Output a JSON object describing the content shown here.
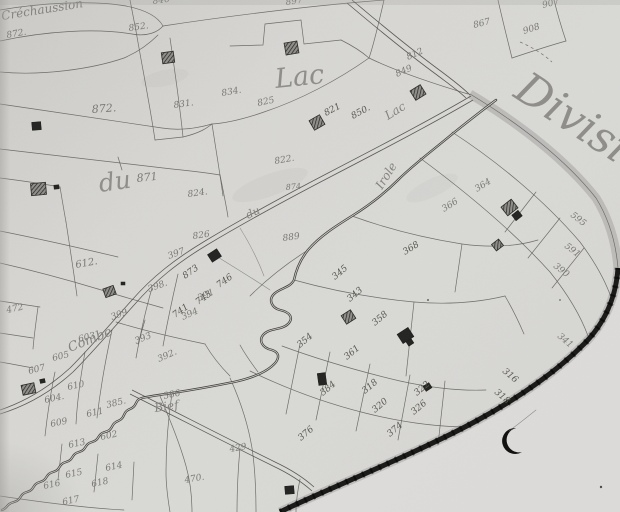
{
  "colors": {
    "paper": "#d7d6d3",
    "paper-light": "#dedddb",
    "paper-dark": "#b9b8b5",
    "ink-line": "#63625e",
    "ink-road": "#55544f",
    "ink-stream": "#45443f",
    "ink-band": "#1b1b19",
    "ink-number": "#7b7a75",
    "ink-number-dark": "#59584f",
    "ink-label": "#84837e",
    "ink-building": "#2b2b28",
    "strip": "#b3b2af"
  },
  "map": {
    "large_labels": [
      {
        "text": "Division",
        "name": "division-label",
        "x": 512,
        "y": 96,
        "r": 33,
        "s": 44
      },
      {
        "text": "Lac",
        "name": "lac-large-label",
        "x": 276,
        "y": 88,
        "r": -6,
        "s": 27
      },
      {
        "text": "du",
        "name": "du-large-label",
        "x": 100,
        "y": 192,
        "r": -8,
        "s": 25
      }
    ],
    "small_labels": [
      {
        "text": "Créchaussion",
        "name": "crechaussion-label",
        "x": 2,
        "y": 20,
        "r": -9,
        "s": 12
      },
      {
        "text": "Combe",
        "name": "combe-label",
        "x": 70,
        "y": 352,
        "r": -22,
        "s": 13
      },
      {
        "text": "Bief",
        "name": "bief-label",
        "x": 155,
        "y": 412,
        "r": -8,
        "s": 12
      },
      {
        "text": "Lac",
        "name": "lac-small-label",
        "x": 388,
        "y": 120,
        "r": -32,
        "s": 12
      },
      {
        "text": "du",
        "name": "du-small-label",
        "x": 248,
        "y": 219,
        "r": -26,
        "s": 11
      },
      {
        "text": "Irole",
        "name": "irole-stream-label",
        "x": 382,
        "y": 190,
        "r": -58,
        "s": 12
      }
    ],
    "parcel_numbers": [
      {
        "t": "852.",
        "x": 129,
        "y": 31,
        "r": -8
      },
      {
        "t": "846",
        "x": 153,
        "y": 4,
        "r": -8
      },
      {
        "t": "897",
        "x": 286,
        "y": 5,
        "r": -8
      },
      {
        "t": "872.",
        "x": 7,
        "y": 38,
        "r": -10
      },
      {
        "t": "907",
        "x": 543,
        "y": 8,
        "r": -14
      },
      {
        "t": "908",
        "x": 524,
        "y": 34,
        "r": -18
      },
      {
        "t": "867",
        "x": 474,
        "y": 28,
        "r": -14
      },
      {
        "t": "812",
        "x": 408,
        "y": 60,
        "r": -24
      },
      {
        "t": "849",
        "x": 397,
        "y": 77,
        "r": -24
      },
      {
        "t": "872.",
        "x": 92,
        "y": 113,
        "r": -4,
        "s": 11
      },
      {
        "t": "834.",
        "x": 222,
        "y": 96,
        "r": -10
      },
      {
        "t": "825",
        "x": 258,
        "y": 106,
        "r": -12
      },
      {
        "t": "831.",
        "x": 174,
        "y": 108,
        "r": -8
      },
      {
        "t": "850.",
        "x": 353,
        "y": 119,
        "r": -28,
        "dk": 1
      },
      {
        "t": "821",
        "x": 326,
        "y": 116,
        "r": -28,
        "dk": 1
      },
      {
        "t": "822.",
        "x": 275,
        "y": 164,
        "r": -10
      },
      {
        "t": "824.",
        "x": 188,
        "y": 197,
        "r": -8
      },
      {
        "t": "874",
        "x": 286,
        "y": 190,
        "r": -5,
        "s": 8
      },
      {
        "t": "871",
        "x": 137,
        "y": 182,
        "r": -6,
        "s": 11
      },
      {
        "t": "826",
        "x": 193,
        "y": 239,
        "r": -8
      },
      {
        "t": "889",
        "x": 283,
        "y": 241,
        "r": -8
      },
      {
        "t": "612.",
        "x": 76,
        "y": 268,
        "r": -10,
        "s": 10
      },
      {
        "t": "472",
        "x": 7,
        "y": 313,
        "r": -12
      },
      {
        "t": "397",
        "x": 169,
        "y": 259,
        "r": -20
      },
      {
        "t": "398.",
        "x": 149,
        "y": 292,
        "r": -20
      },
      {
        "t": "399",
        "x": 112,
        "y": 320,
        "r": -20
      },
      {
        "t": "391",
        "x": 199,
        "y": 301,
        "r": -24
      },
      {
        "t": "394",
        "x": 183,
        "y": 320,
        "r": -24
      },
      {
        "t": "393",
        "x": 136,
        "y": 344,
        "r": -22
      },
      {
        "t": "392.",
        "x": 159,
        "y": 362,
        "r": -24
      },
      {
        "t": "385.",
        "x": 107,
        "y": 408,
        "r": -14
      },
      {
        "t": "386",
        "x": 164,
        "y": 399,
        "r": -12
      },
      {
        "t": "605",
        "x": 53,
        "y": 361,
        "r": -14
      },
      {
        "t": "603",
        "x": 79,
        "y": 342,
        "r": -14
      },
      {
        "t": "607",
        "x": 29,
        "y": 374,
        "r": -14
      },
      {
        "t": "610",
        "x": 68,
        "y": 390,
        "r": -12
      },
      {
        "t": "604.",
        "x": 45,
        "y": 403,
        "r": -12
      },
      {
        "t": "611",
        "x": 87,
        "y": 417,
        "r": -12
      },
      {
        "t": "609",
        "x": 51,
        "y": 427,
        "r": -12
      },
      {
        "t": "602",
        "x": 101,
        "y": 440,
        "r": -12
      },
      {
        "t": "613",
        "x": 69,
        "y": 448,
        "r": -12
      },
      {
        "t": "614",
        "x": 106,
        "y": 471,
        "r": -12
      },
      {
        "t": "615",
        "x": 66,
        "y": 478,
        "r": -12
      },
      {
        "t": "616",
        "x": 44,
        "y": 489,
        "r": -12
      },
      {
        "t": "617",
        "x": 63,
        "y": 505,
        "r": -12
      },
      {
        "t": "618",
        "x": 92,
        "y": 487,
        "r": -12
      },
      {
        "t": "429.",
        "x": 230,
        "y": 452,
        "r": -10
      },
      {
        "t": "470.",
        "x": 185,
        "y": 483,
        "r": -10
      },
      {
        "t": "873",
        "x": 185,
        "y": 279,
        "r": -35,
        "dk": 1
      },
      {
        "t": "746",
        "x": 219,
        "y": 288,
        "r": -35,
        "dk": 1
      },
      {
        "t": "743",
        "x": 198,
        "y": 305,
        "r": -35,
        "dk": 1
      },
      {
        "t": "741",
        "x": 175,
        "y": 318,
        "r": -35,
        "dk": 1
      },
      {
        "t": "345",
        "x": 335,
        "y": 280,
        "r": -40,
        "dk": 1
      },
      {
        "t": "343",
        "x": 350,
        "y": 302,
        "r": -40,
        "dk": 1
      },
      {
        "t": "358",
        "x": 375,
        "y": 326,
        "r": -40,
        "dk": 1
      },
      {
        "t": "354",
        "x": 300,
        "y": 348,
        "r": -40,
        "dk": 1
      },
      {
        "t": "361",
        "x": 347,
        "y": 360,
        "r": -40,
        "dk": 1
      },
      {
        "t": "384",
        "x": 323,
        "y": 396,
        "r": -40,
        "dk": 1
      },
      {
        "t": "318",
        "x": 365,
        "y": 394,
        "r": -40,
        "dk": 1
      },
      {
        "t": "320",
        "x": 375,
        "y": 413,
        "r": -40,
        "dk": 1
      },
      {
        "t": "322",
        "x": 417,
        "y": 396,
        "r": -40,
        "dk": 1
      },
      {
        "t": "326",
        "x": 414,
        "y": 415,
        "r": -40,
        "dk": 1
      },
      {
        "t": "374",
        "x": 390,
        "y": 437,
        "r": -40,
        "dk": 1
      },
      {
        "t": "376",
        "x": 301,
        "y": 441,
        "r": -40,
        "dk": 1
      },
      {
        "t": "595",
        "x": 570,
        "y": 216,
        "r": 38
      },
      {
        "t": "591",
        "x": 564,
        "y": 247,
        "r": 38
      },
      {
        "t": "390",
        "x": 553,
        "y": 267,
        "r": 38
      },
      {
        "t": "341",
        "x": 557,
        "y": 337,
        "r": 40
      },
      {
        "t": "316",
        "x": 502,
        "y": 372,
        "r": 40,
        "dk": 1
      },
      {
        "t": "318",
        "x": 494,
        "y": 393,
        "r": 40,
        "dk": 1
      },
      {
        "t": "364",
        "x": 477,
        "y": 192,
        "r": -32
      },
      {
        "t": "366",
        "x": 444,
        "y": 212,
        "r": -32
      },
      {
        "t": "368",
        "x": 405,
        "y": 255,
        "r": -32,
        "dk": 1
      }
    ],
    "buildings": [
      {
        "x": 162,
        "y": 52,
        "w": 12,
        "h": 11,
        "r": -8,
        "k": "h"
      },
      {
        "x": 285,
        "y": 42,
        "w": 13,
        "h": 12,
        "r": -10,
        "k": "h"
      },
      {
        "x": 32,
        "y": 122,
        "w": 9,
        "h": 8,
        "r": -5,
        "k": "d"
      },
      {
        "x": 311,
        "y": 117,
        "w": 12,
        "h": 11,
        "r": -30,
        "k": "h"
      },
      {
        "x": 412,
        "y": 87,
        "w": 12,
        "h": 11,
        "r": -32,
        "k": "h"
      },
      {
        "x": 31,
        "y": 183,
        "w": 15,
        "h": 12,
        "r": -5,
        "k": "h"
      },
      {
        "x": 54,
        "y": 185,
        "w": 5,
        "h": 4,
        "r": -5,
        "k": "d"
      },
      {
        "x": 104,
        "y": 287,
        "w": 11,
        "h": 9,
        "r": -20,
        "k": "h"
      },
      {
        "x": 121,
        "y": 282,
        "w": 4,
        "h": 3,
        "r": 0,
        "k": "d"
      },
      {
        "x": 209,
        "y": 251,
        "w": 11,
        "h": 9,
        "r": -33,
        "k": "d"
      },
      {
        "x": 343,
        "y": 312,
        "w": 11,
        "h": 10,
        "r": -33,
        "k": "h"
      },
      {
        "x": 399,
        "y": 330,
        "w": 13,
        "h": 11,
        "r": -33,
        "k": "d"
      },
      {
        "x": 407,
        "y": 340,
        "w": 6,
        "h": 5,
        "r": -33,
        "k": "d"
      },
      {
        "x": 318,
        "y": 373,
        "w": 8,
        "h": 12,
        "r": -8,
        "k": "d"
      },
      {
        "x": 424,
        "y": 384,
        "w": 7,
        "h": 6,
        "r": -33,
        "k": "d"
      },
      {
        "x": 503,
        "y": 202,
        "w": 13,
        "h": 11,
        "r": -38,
        "k": "h"
      },
      {
        "x": 513,
        "y": 212,
        "w": 8,
        "h": 7,
        "r": -38,
        "k": "d"
      },
      {
        "x": 493,
        "y": 241,
        "w": 9,
        "h": 8,
        "r": -38,
        "k": "h"
      },
      {
        "x": 22,
        "y": 384,
        "w": 13,
        "h": 10,
        "r": -12,
        "k": "h"
      },
      {
        "x": 40,
        "y": 379,
        "w": 5,
        "h": 4,
        "r": -12,
        "k": "d"
      },
      {
        "x": 285,
        "y": 486,
        "w": 9,
        "h": 8,
        "r": -5,
        "k": "d"
      }
    ]
  }
}
